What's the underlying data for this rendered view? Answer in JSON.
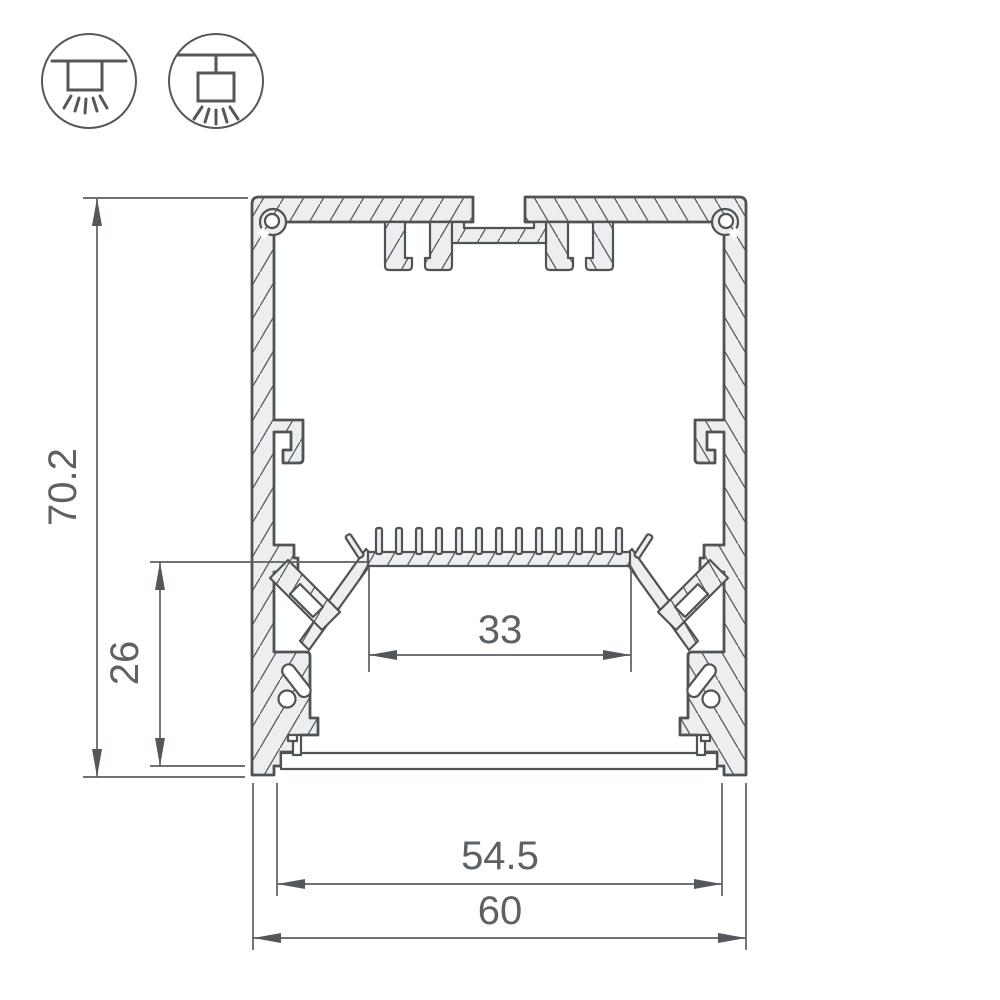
{
  "drawing": {
    "title": "aluminium-led-profile-cross-section",
    "dimensions": {
      "total_height": "70.2",
      "chamber_height": "26",
      "led_shelf_width": "33",
      "cover_width": "54.5",
      "total_width": "60"
    },
    "icons": [
      {
        "name": "surface-mount-luminaire-icon"
      },
      {
        "name": "pendant-mount-luminaire-icon"
      }
    ],
    "colors": {
      "line": "#4e5357",
      "metal_fill": "#eceeef",
      "text": "#5c6165",
      "background": "#ffffff"
    }
  }
}
